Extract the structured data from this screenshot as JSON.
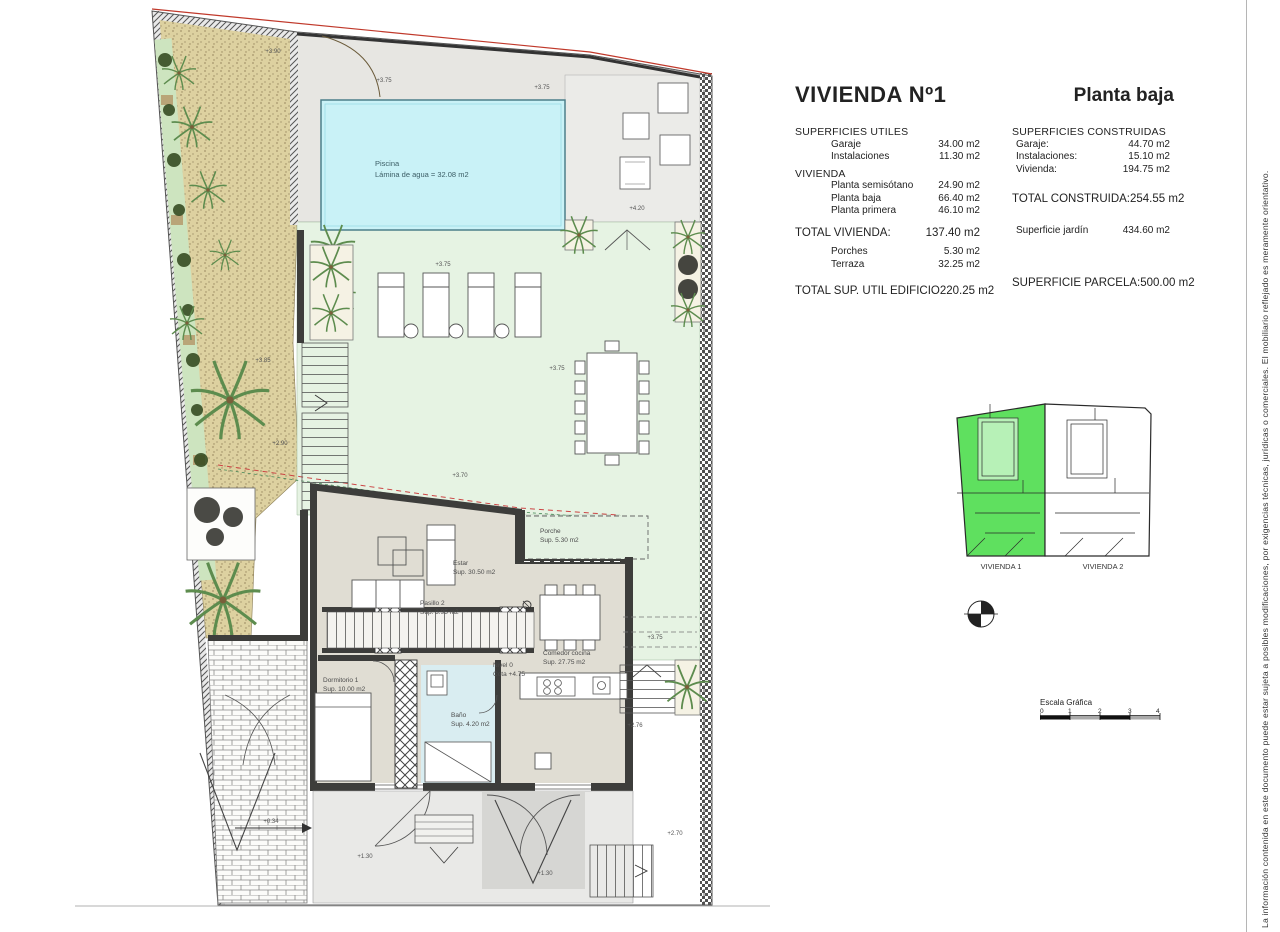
{
  "title_block": {
    "title": "VIVIENDA Nº1",
    "subtitle": "Planta baja",
    "utiles": {
      "header": "SUPERFICIES UTILES",
      "rows": [
        {
          "label": "Garaje",
          "value": "34.00 m2"
        },
        {
          "label": "Instalaciones",
          "value": "11.30 m2"
        }
      ],
      "vivienda_header": "VIVIENDA",
      "vrows": [
        {
          "label": "Planta semisótano",
          "value": "24.90 m2"
        },
        {
          "label": "Planta baja",
          "value": "66.40 m2"
        },
        {
          "label": "Planta primera",
          "value": "46.10 m2"
        }
      ],
      "total_label": "TOTAL VIVIENDA:",
      "total_value": "137.40 m2",
      "extra": [
        {
          "label": "Porches",
          "value": "5.30 m2"
        },
        {
          "label": "Terraza",
          "value": "32.25 m2"
        }
      ],
      "grand_label": "TOTAL SUP. UTIL EDIFICIO",
      "grand_value": "220.25 m2"
    },
    "construidas": {
      "header": "SUPERFICIES CONSTRUIDAS",
      "rows": [
        {
          "label": "Garaje:",
          "value": "44.70 m2"
        },
        {
          "label": "Instalaciones:",
          "value": "15.10 m2"
        },
        {
          "label": "Vivienda:",
          "value": "194.75 m2"
        }
      ],
      "total_label": "TOTAL CONSTRUIDA:",
      "total_value": "254.55 m2",
      "jardin": {
        "label": "Superficie jardín",
        "value": "434.60 m2"
      },
      "parcela": {
        "label": "SUPERFICIE PARCELA:",
        "value": "500.00 m2"
      }
    }
  },
  "key_plan": {
    "unit1": "VIVIENDA 1",
    "unit2": "VIVIENDA 2",
    "highlight_color": "#5fe05f"
  },
  "scale_bar": {
    "title": "Escala Gráfica",
    "ticks": [
      "0",
      "1",
      "2",
      "3",
      "4"
    ]
  },
  "disclaimer": "La información contenida en este documento puede estar sujeta a posibles modificaciones, por exigencias técnicas, jurídicas o comerciales. El mobiliario reflejado es meramente orientativo.",
  "plan": {
    "pool": {
      "name": "Piscina",
      "area": "Lámina de agua = 32.08 m2"
    },
    "rooms": {
      "estar": {
        "name": "Estar",
        "area": "Sup. 30.50 m2"
      },
      "porche": {
        "name": "Porche",
        "area": "Sup. 5.30 m2"
      },
      "nivel": {
        "name": "Nivel 0",
        "area": "Cota +4.75"
      },
      "comedor": {
        "name": "Comedor cocina",
        "area": "Sup. 27.75 m2"
      },
      "pasillo": {
        "name": "Pasillo 2",
        "area": "Sup. 3.95 m2"
      },
      "dormitorio": {
        "name": "Dormitorio 1",
        "area": "Sup. 10.00 m2"
      },
      "bano": {
        "name": "Baño",
        "area": "Sup. 4.20 m2"
      }
    },
    "levels": {
      "pool_deck_left": "+3.75",
      "pool_deck_right": "+3.75",
      "terrace": "+4.20",
      "lawn_top": "+3.75",
      "lawn_mid": "+3.75",
      "lawn_bottom": "+3.70",
      "garden_upper": "+3.85",
      "garden_lower": "+2.90",
      "gate": "+3.90",
      "side_path": "+3.75",
      "porch_rear": "+2.76",
      "stairs_out": "+2.70",
      "patio_left": "+1.30",
      "patio_right": "+1.30",
      "ramp": "+0.34"
    }
  },
  "colors": {
    "pool_water": "#c9f2f7",
    "lawn": "#e6f3e3",
    "gravel": "#ddd1a0",
    "highlight_green": "#5fe05f",
    "boundary_red": "#c0392b"
  }
}
